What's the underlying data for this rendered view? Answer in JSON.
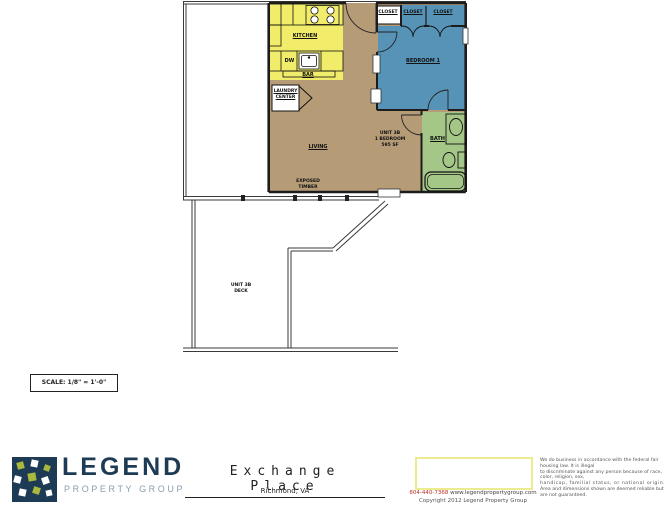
{
  "page": {
    "scale_label": "SCALE:  1/8\" = 1'-0\""
  },
  "plan": {
    "room_labels": {
      "kitchen": "KITCHEN",
      "living": "LIVING",
      "bedroom": "BEDROOM 1",
      "bath": "BATH",
      "bar": "BAR",
      "dishwasher": "DW",
      "laundry": {
        "line1": "LAUNDRY",
        "line2": "CENTER"
      },
      "closets": [
        "CLOSET",
        "CLOSET",
        "CLOSET"
      ],
      "feature": {
        "line1": "EXPOSED",
        "line2": "TIMBER"
      }
    },
    "unit_info": {
      "line1": "UNIT 3B",
      "line2": "1 BEDROOM",
      "line3": "595 SF"
    },
    "deck": {
      "line1": "UNIT 3B",
      "line2": "DECK"
    },
    "colors": {
      "floor": "#b69b77",
      "kitchen": "#f1ec6a",
      "bedroom": "#5793b6",
      "bath": "#a4c787",
      "wall": "#1c1c1c"
    }
  },
  "footer": {
    "logo": {
      "name": "LEGEND",
      "tagline": "PROPERTY GROUP",
      "navy": "#1e3b55",
      "green": "#a9b93e",
      "gray": "#8b9dad"
    },
    "title": "Exchange Place",
    "subtitle": "Richmond, VA",
    "contact": {
      "phone": "804-440-7368",
      "website": "www.legendpropertygroup.com",
      "copyright": "Copyright 2012 Legend Property Group"
    },
    "legal": {
      "line1": "We do business in accordance with the federal fair housing law.  It is illegal",
      "line2": "to discriminate against any person because of race, color, religion, sex,",
      "line3": "handicap, familial status, or national origin.",
      "line4": "Area and dimensions shown are deemed reliable but are not guaranteed."
    }
  }
}
